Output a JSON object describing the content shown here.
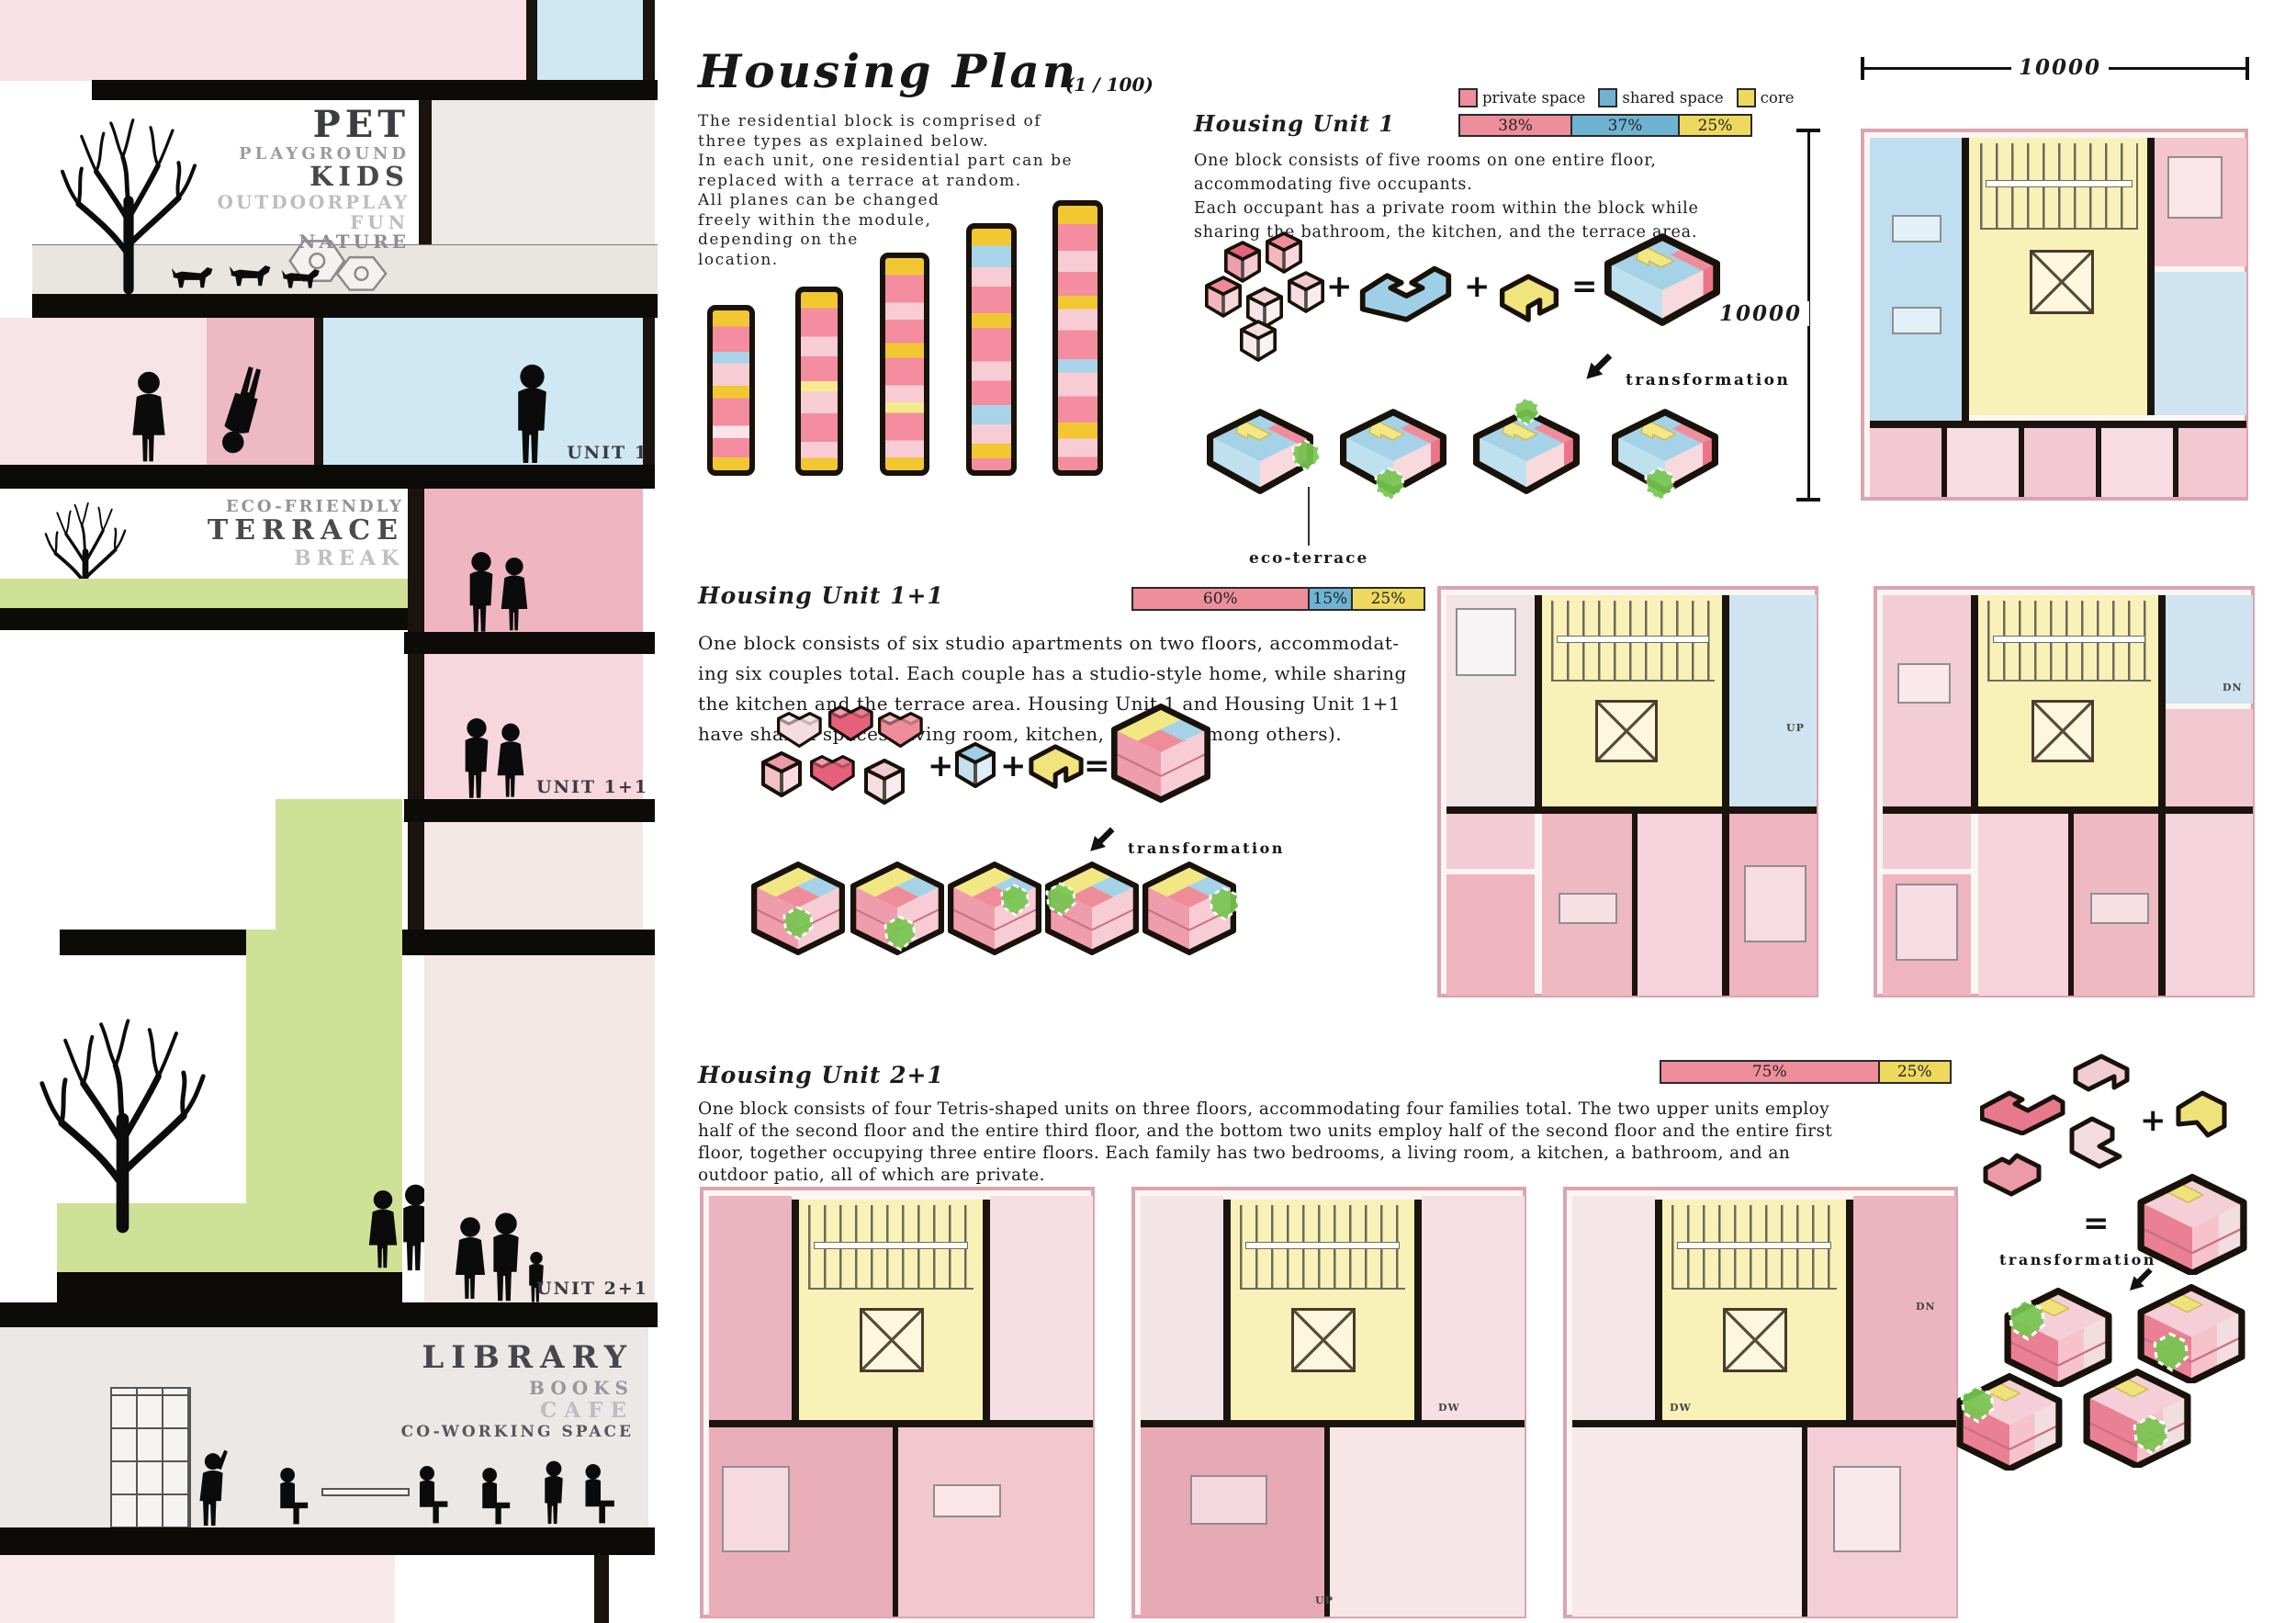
{
  "colors": {
    "private_space": "#ef8e9b",
    "shared_space": "#6fb3d2",
    "core": "#eed95e",
    "eco_terrace_green": "#7ec84f",
    "section_pink": "#efb5c1",
    "section_blue": "#cfe8f4"
  },
  "header": {
    "title": "Housing Plan",
    "scale": "(1 / 100)",
    "intro": "The residential block is comprised of\nthree types as explained below.\n In each unit, one residential part can be\nreplaced with a terrace at random.\nAll planes can be changed\nfreely within the module,\ndepending on the\nlocation."
  },
  "legend": {
    "items": [
      {
        "label": "private space",
        "color": "#ef8e9b"
      },
      {
        "label": "shared space",
        "color": "#6fb3d2"
      },
      {
        "label": "core",
        "color": "#eed95e"
      }
    ]
  },
  "units": {
    "unit1": {
      "heading": "Housing Unit 1",
      "bar": [
        {
          "label": "38%"
        },
        {
          "label": "37%"
        },
        {
          "label": "25%"
        }
      ],
      "desc": "One block consists of five rooms on one entire floor,\naccommodating five occupants.\nEach occupant has a private room within the block while\nsharing the bathroom, the kitchen, and the terrace area.",
      "transformation": "transformation",
      "eco_terrace": "eco-terrace"
    },
    "unit11": {
      "heading": "Housing Unit 1+1",
      "bar": [
        {
          "label": "60%"
        },
        {
          "label": "15%"
        },
        {
          "label": "25%"
        }
      ],
      "desc": "One block consists of six studio apartments on two floors, accommodat-\ning six couples total. Each couple has a studio-style home, while sharing\nthe kitchen and the terrace area. Housing Unit 1 and Housing Unit 1+1\nhave shared spaces (living room, kitchen, terrace, among others).",
      "transformation": "transformation"
    },
    "unit21": {
      "heading": "Housing Unit 2+1",
      "bar": [
        {
          "label": "75%"
        },
        {
          "label": "25%"
        }
      ],
      "desc": "One block consists of four Tetris-shaped units on three floors, accommodating four families total. The two upper units employ\nhalf of the second floor and the entire third floor, and the bottom two units employ half of the second floor and the entire first\nfloor, together occupying three entire floors. Each family has two bedrooms, a living room, a kitchen, a bathroom, and an\noutdoor patio, all of which are private.",
      "transformation": "transformation"
    }
  },
  "section": {
    "pet": [
      "PET",
      "PLAYGROUND",
      "KIDS",
      "OUTDOORPLAY",
      "FUN",
      "NATURE"
    ],
    "terrace": [
      "ECO-FRIENDLY",
      "TERRACE",
      "BREAK"
    ],
    "library": [
      "LIBRARY",
      "BOOKS",
      "CAFE",
      "CO-WORKING SPACE"
    ],
    "tags": [
      "UNIT 1",
      "UNIT 1+1",
      "UNIT 2+1"
    ]
  },
  "dims": {
    "h": "10000",
    "v": "10000"
  },
  "plan_labels": {
    "up": "UP",
    "dn": "DN",
    "dw": "DW"
  },
  "ops": {
    "plus": "+",
    "equals": "="
  }
}
